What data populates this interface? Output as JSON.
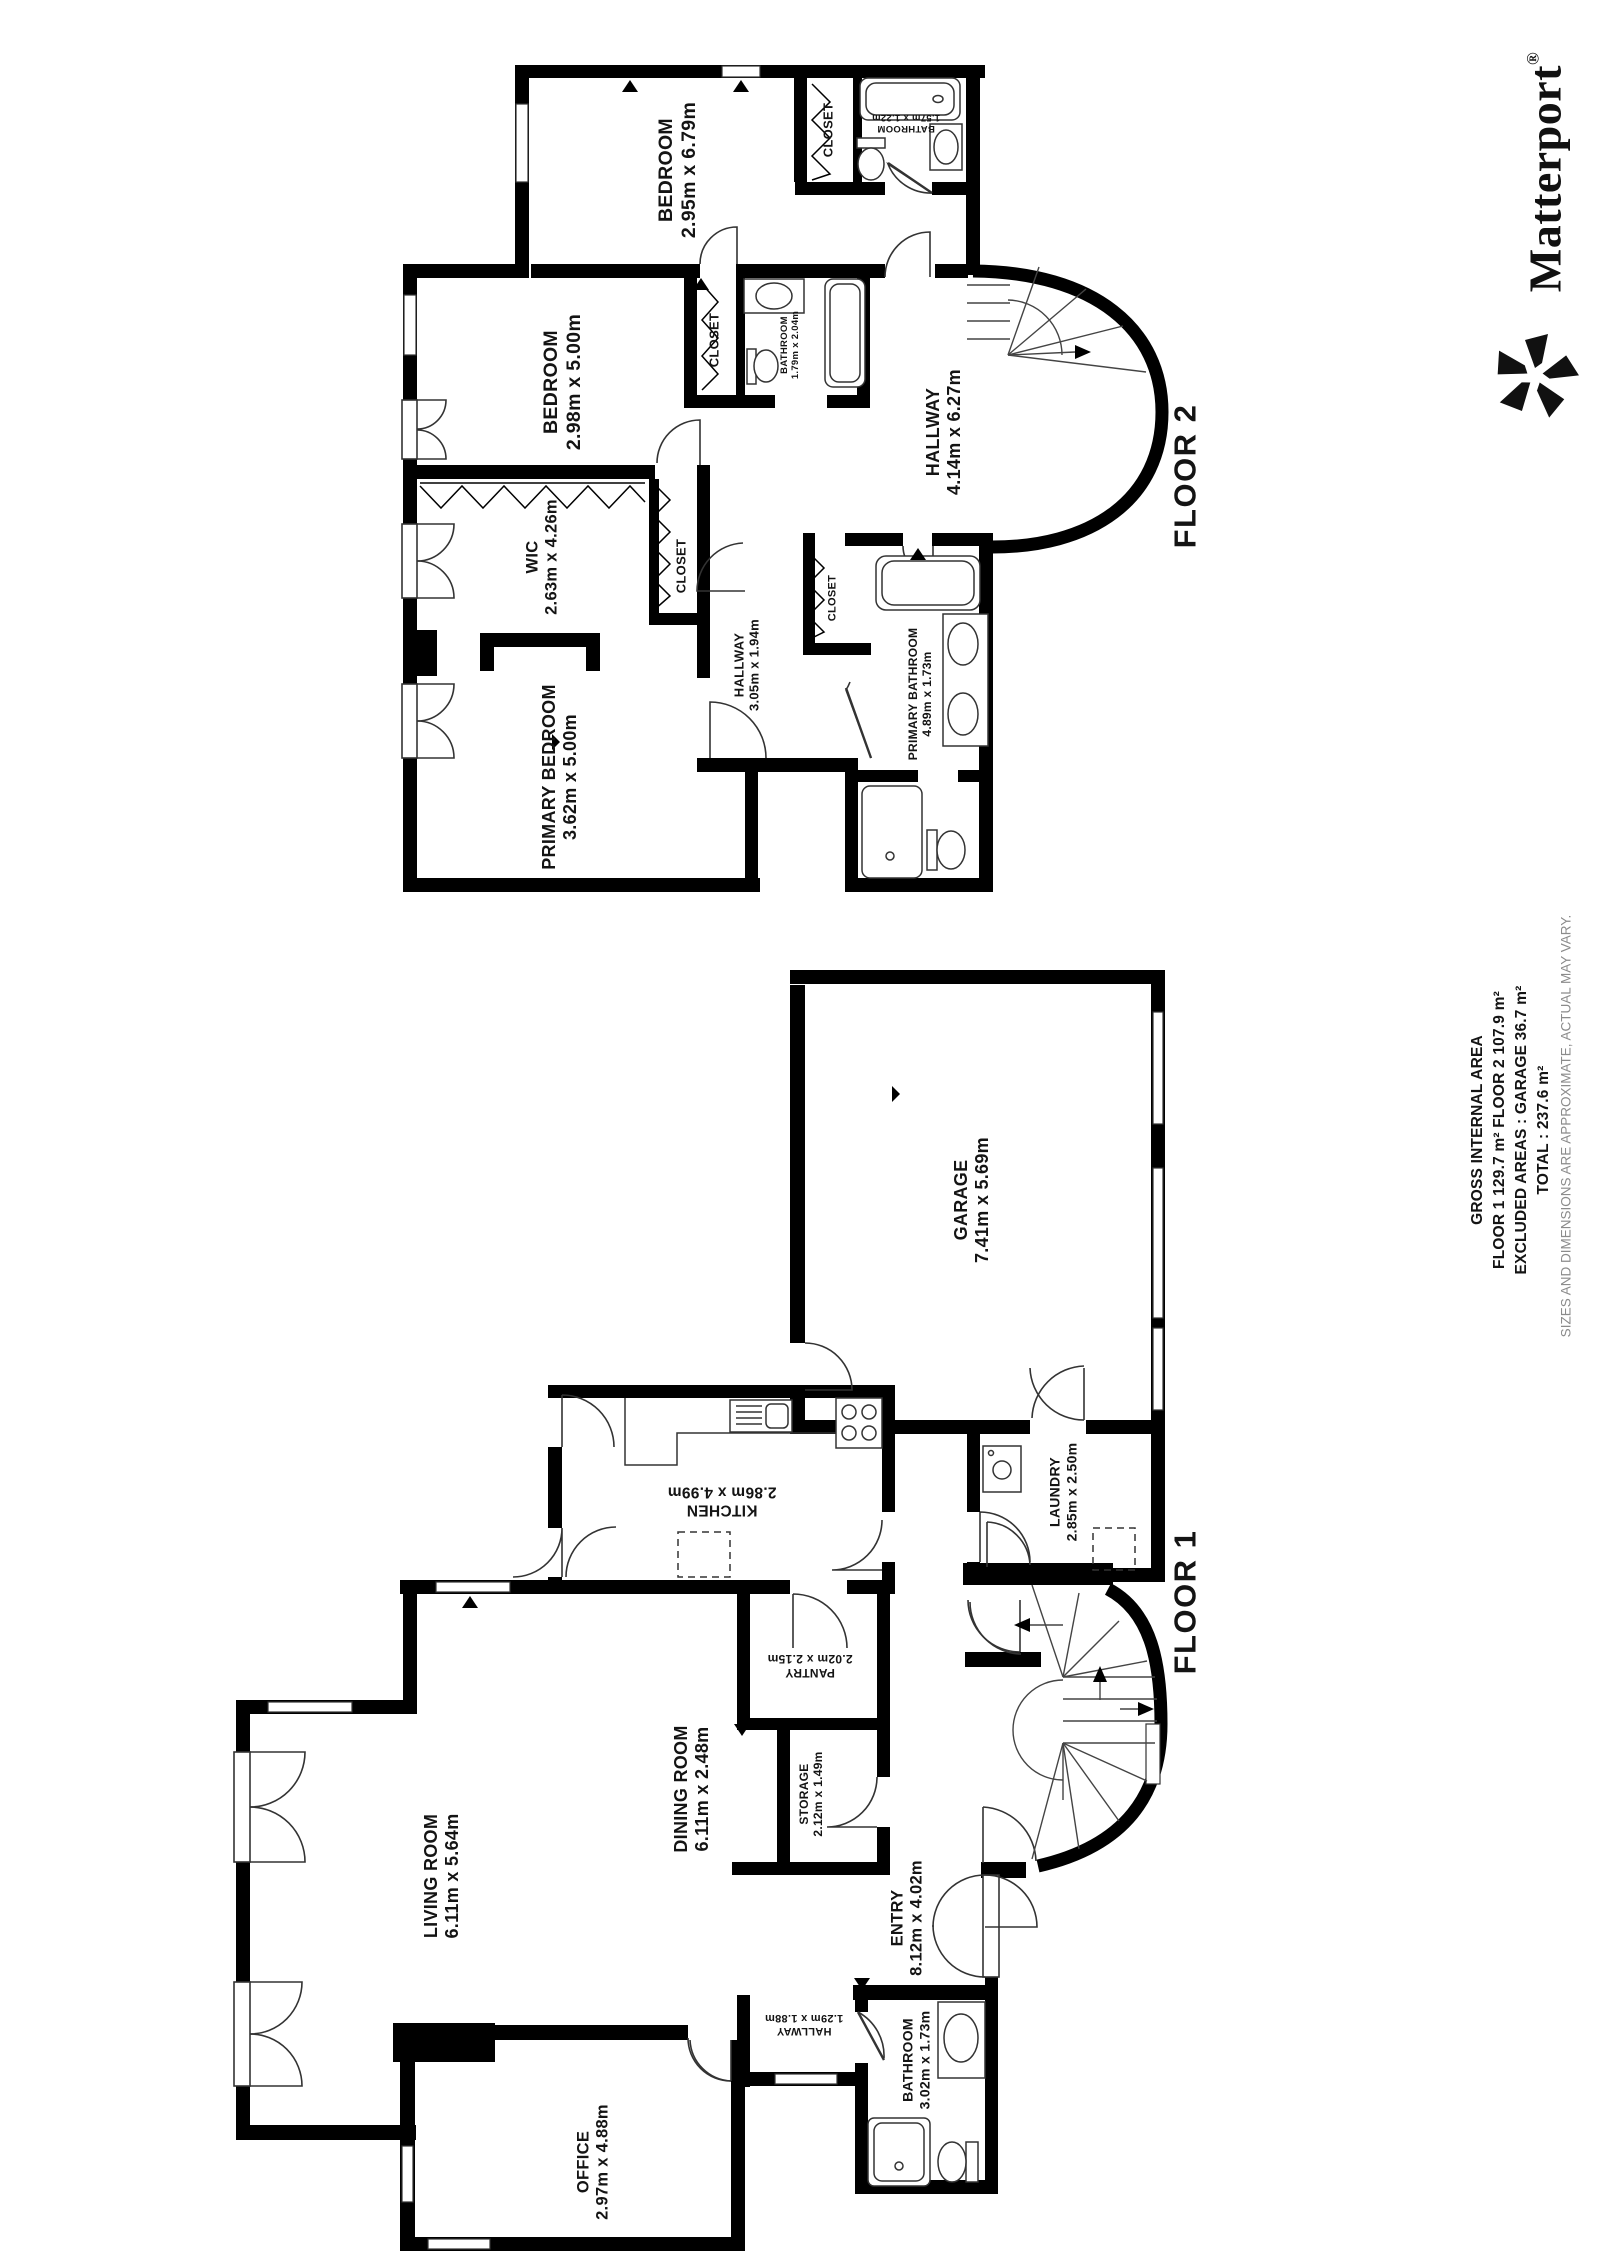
{
  "branding": {
    "logo_text": "Matterport",
    "registered_mark": "®"
  },
  "area_summary": {
    "title": "GROSS INTERNAL AREA",
    "line_floors": "FLOOR 1 129.7 m²   FLOOR 2 107.9 m²",
    "line_excluded": "EXCLUDED AREAS :  GARAGE 36.7 m²",
    "line_total": "TOTAL :  237.6 m²",
    "disclaimer": "SIZES AND DIMENSIONS ARE APPROXIMATE, ACTUAL MAY VARY."
  },
  "floors": [
    {
      "label": "FLOOR 2",
      "rooms": [
        {
          "name": "BEDROOM",
          "dims": "2.95m x 6.79m"
        },
        {
          "name": "BEDROOM",
          "dims": "2.98m x 5.00m"
        },
        {
          "name": "CLOSET",
          "dims": ""
        },
        {
          "name": "BATHROOM",
          "dims": "1.57m x 1.22m"
        },
        {
          "name": "CLOSET",
          "dims": ""
        },
        {
          "name": "BATHROOM",
          "dims": "1.79m x 2.04m"
        },
        {
          "name": "HALLWAY",
          "dims": "4.14m x 6.27m"
        },
        {
          "name": "WIC",
          "dims": "2.63m x 4.26m"
        },
        {
          "name": "CLOSET",
          "dims": ""
        },
        {
          "name": "HALLWAY",
          "dims": "3.05m x 1.94m"
        },
        {
          "name": "CLOSET",
          "dims": ""
        },
        {
          "name": "PRIMARY BATHROOM",
          "dims": "4.89m x 1.73m"
        },
        {
          "name": "PRIMARY BEDROOM",
          "dims": "3.62m x 5.00m"
        }
      ]
    },
    {
      "label": "FLOOR 1",
      "rooms": [
        {
          "name": "GARAGE",
          "dims": "7.41m x 5.69m"
        },
        {
          "name": "LAUNDRY",
          "dims": "2.85m x 2.50m"
        },
        {
          "name": "KITCHEN",
          "dims": "2.86m x 4.99m"
        },
        {
          "name": "PANTRY",
          "dims": "2.02m x 2.15m"
        },
        {
          "name": "STORAGE",
          "dims": "2.12m x 1.49m"
        },
        {
          "name": "DINING ROOM",
          "dims": "6.11m x 2.48m"
        },
        {
          "name": "LIVING ROOM",
          "dims": "6.11m x 5.64m"
        },
        {
          "name": "OFFICE",
          "dims": "2.97m x 4.88m"
        },
        {
          "name": "ENTRY",
          "dims": "8.12m x 4.02m"
        },
        {
          "name": "HALLWAY",
          "dims": "1.29m x 1.88m"
        },
        {
          "name": "BATHROOM",
          "dims": "3.02m x 1.73m"
        }
      ]
    }
  ]
}
